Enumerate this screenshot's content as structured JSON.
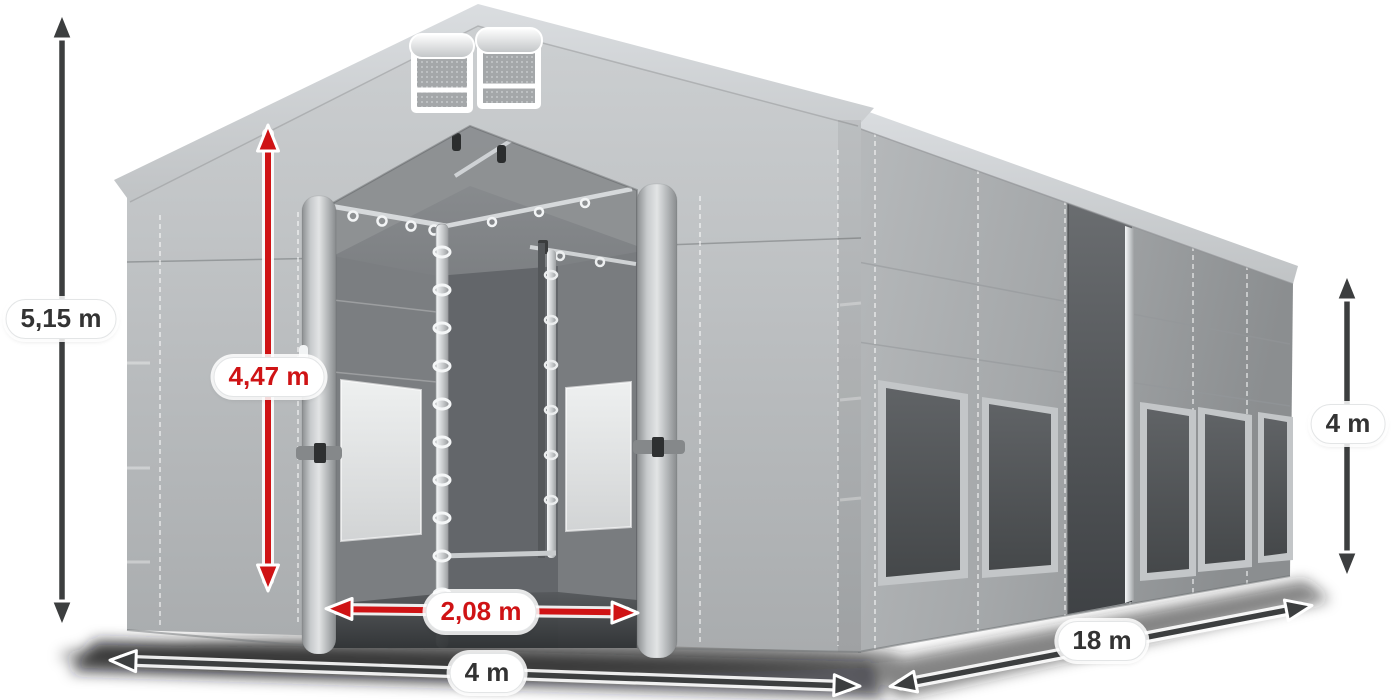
{
  "meta": {
    "description": "3D product render of a grey PVC storage tent (gable entrance open) annotated with dimension arrows"
  },
  "colors": {
    "accent_red": "#cf1315",
    "arrow_dark": "#3c3e3f",
    "label_text_dark": "#333333",
    "label_bg": "#ffffff",
    "background": "#ffffff",
    "tent_light_grey": "#c6c9cb",
    "tent_mid_grey": "#a9acae",
    "tent_interior_grey": "#5f6264"
  },
  "dimensions": [
    {
      "id": "total-height",
      "value": "5,15 m",
      "style": "dark",
      "orientation": "vertical"
    },
    {
      "id": "entrance-height",
      "value": "4,47 m",
      "style": "red",
      "orientation": "vertical"
    },
    {
      "id": "entrance-width",
      "value": "2,08 m",
      "style": "red",
      "orientation": "horizontal"
    },
    {
      "id": "front-width",
      "value": "4 m",
      "style": "dark",
      "orientation": "horizontal"
    },
    {
      "id": "side-length",
      "value": "18 m",
      "style": "dark",
      "orientation": "diagonal"
    },
    {
      "id": "side-height",
      "value": "4 m",
      "style": "dark",
      "orientation": "vertical"
    }
  ]
}
